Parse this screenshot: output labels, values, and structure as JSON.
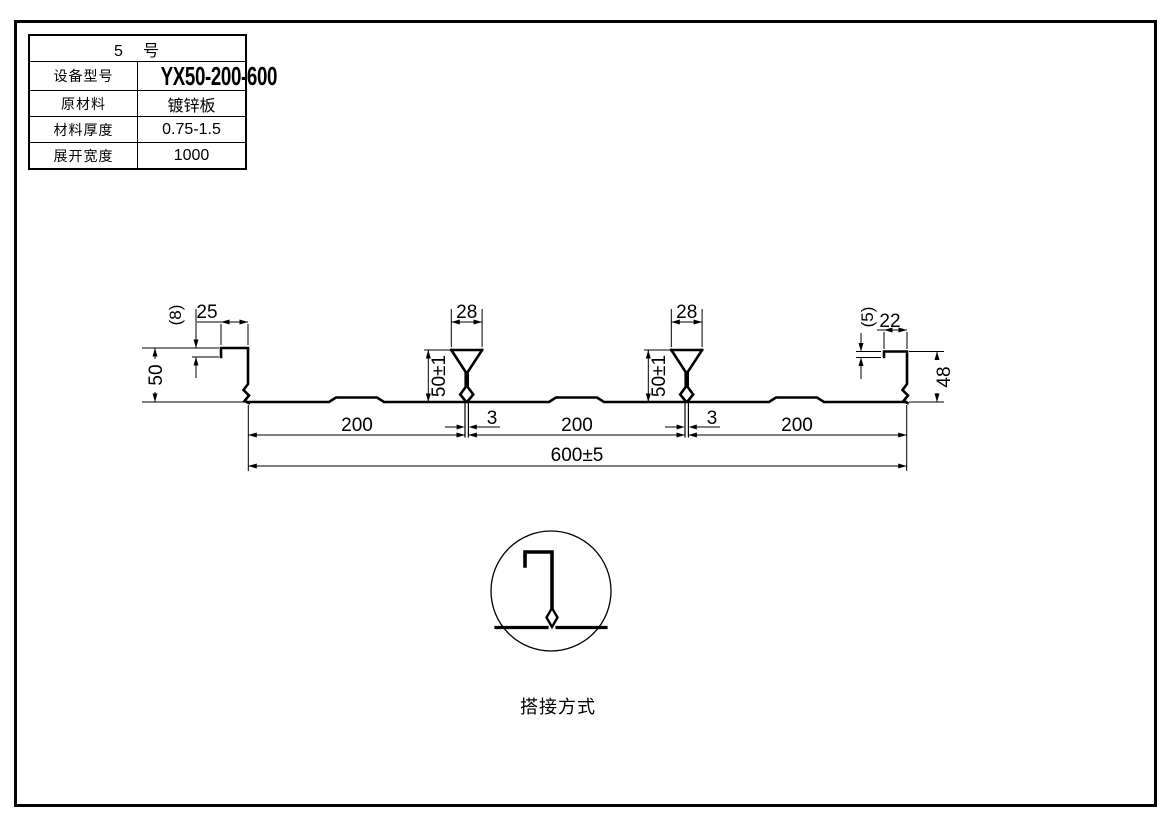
{
  "spec_table": {
    "header": "5　号",
    "rows": [
      {
        "label": "设备型号",
        "value": "YX50-200-600"
      },
      {
        "label": "原材料",
        "value": "镀锌板"
      },
      {
        "label": "材料厚度",
        "value": "0.75-1.5"
      },
      {
        "label": "展开宽度",
        "value": "1000"
      }
    ]
  },
  "profile": {
    "left_end": {
      "lip": "(8)",
      "flange": "25",
      "height": "50"
    },
    "rib1": {
      "width": "28",
      "height": "50±1",
      "seam": "3"
    },
    "rib2": {
      "width": "28",
      "height": "50±1",
      "seam": "3"
    },
    "right_end": {
      "lip": "(5)",
      "flange": "22",
      "height": "48"
    },
    "spans": [
      "200",
      "200",
      "200"
    ],
    "overall_width": "600±5"
  },
  "detail": {
    "label": "搭接方式"
  },
  "colors": {
    "line": "#000000",
    "background": "#ffffff"
  }
}
